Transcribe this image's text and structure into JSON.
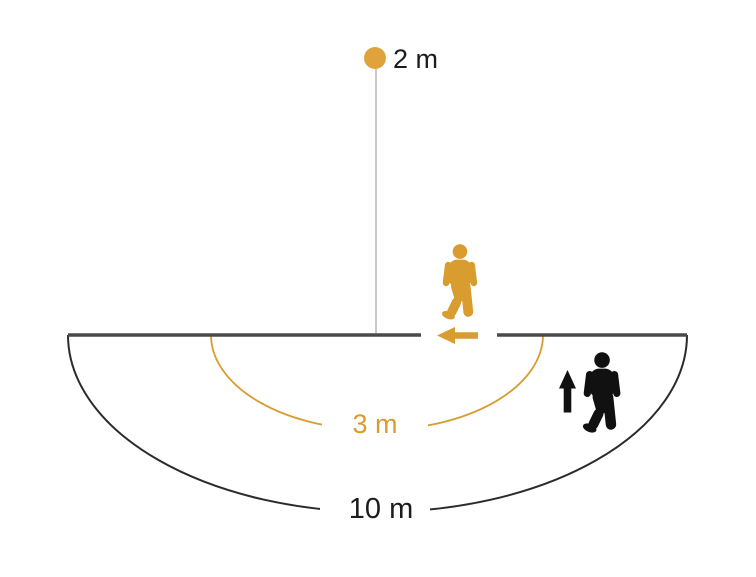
{
  "diagram": {
    "labels": {
      "mounting_height": "2 m",
      "inner_radius": "3 m",
      "outer_radius": "10 m"
    },
    "icons": {
      "sensor": "sensor-dot-icon",
      "approaching_person": "walking-person-approaching-icon",
      "crossing_person": "walking-person-crossing-icon",
      "approach_direction": "arrow-left-icon",
      "crossing_direction": "arrow-up-icon"
    },
    "colors": {
      "accent_orange": "#D89C2F",
      "dot_orange": "#E0A33C",
      "arc_dark": "#2B2B2B",
      "baseline_gray": "#4A4A4A",
      "drop_line_gray": "#ABABAB",
      "text_black": "#1C1C1C",
      "figure_black": "#111111",
      "background": "#FFFFFF"
    }
  }
}
